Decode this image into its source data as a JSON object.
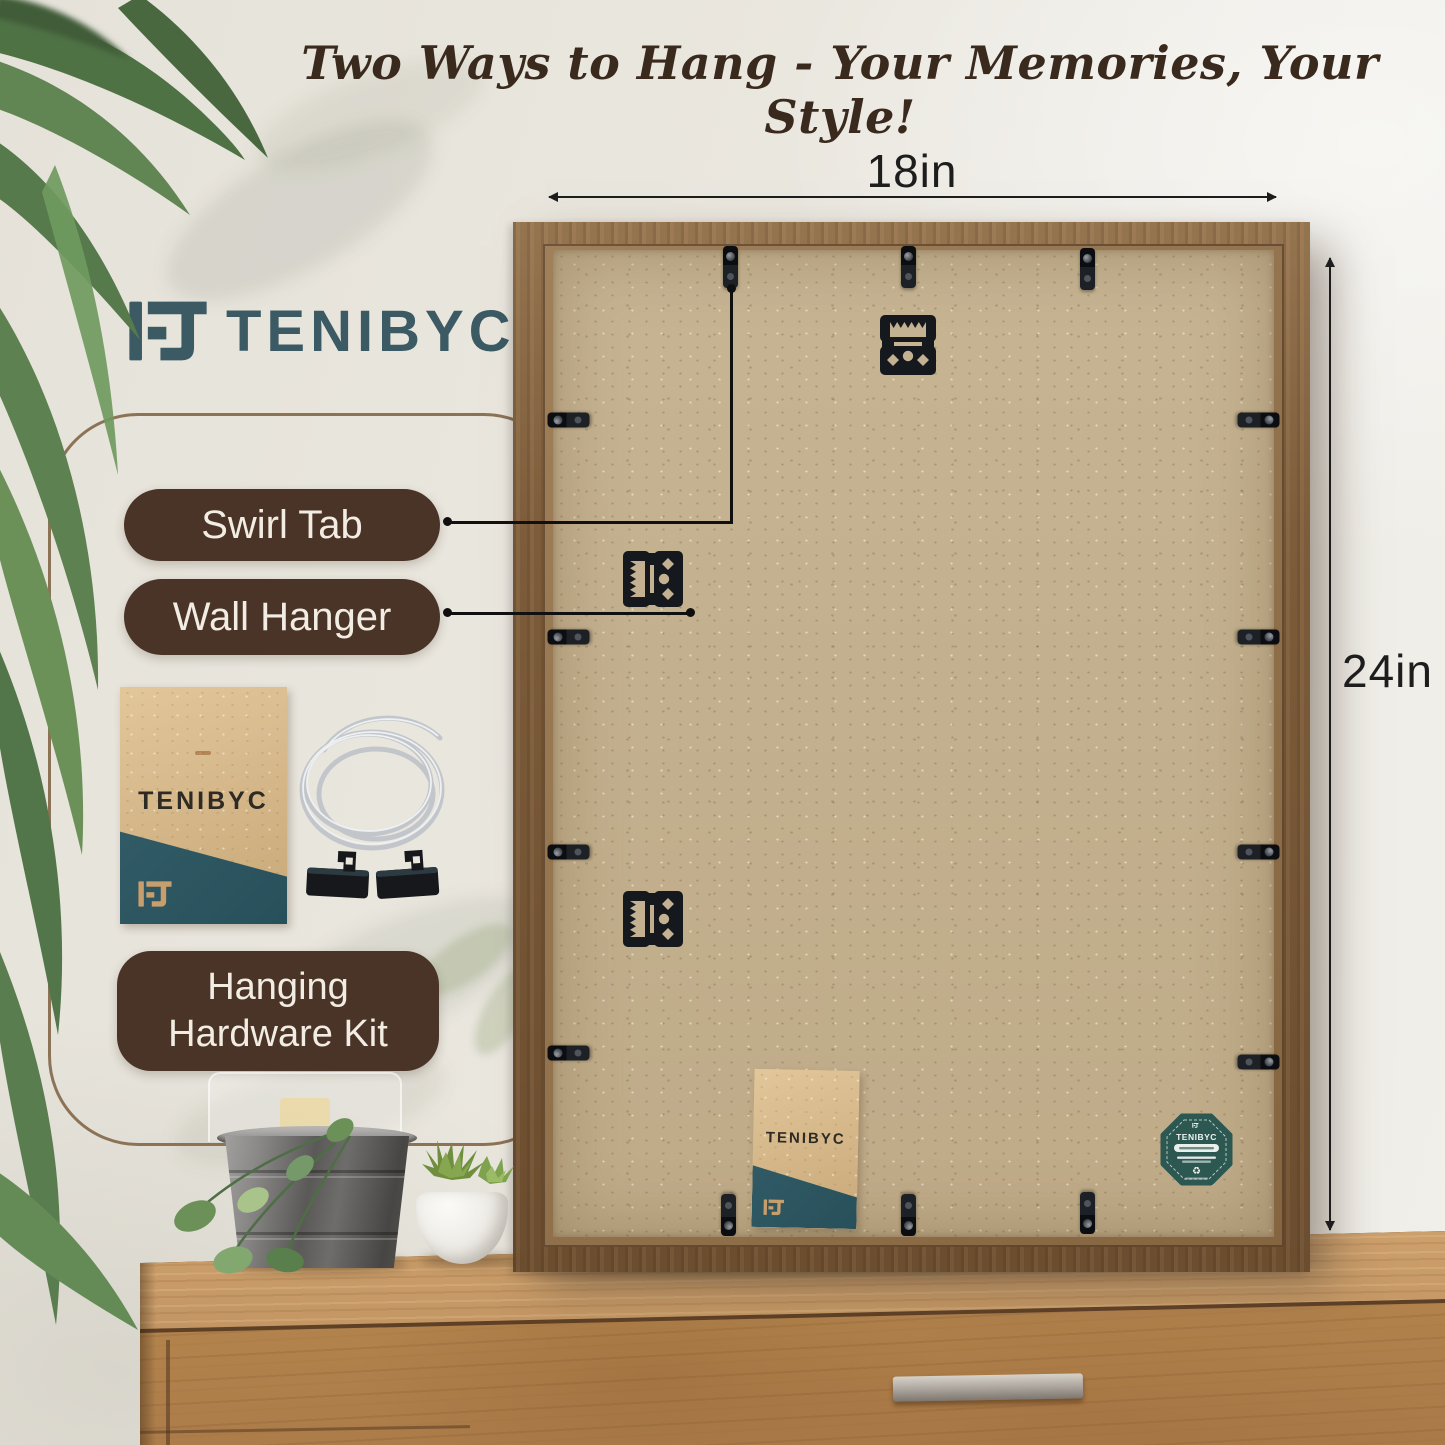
{
  "header": {
    "title": "Two Ways to Hang - Your Memories, Your Style!"
  },
  "brand": {
    "wordmark": "TENIBYC",
    "color": "#3b5a64"
  },
  "dimensions": {
    "width_label": "18in",
    "height_label": "24in"
  },
  "callouts": {
    "swirl_tab": "Swirl Tab",
    "wall_hanger": "Wall Hanger",
    "kit_line1": "Hanging",
    "kit_line2": "Hardware Kit"
  },
  "frame_back": {
    "swirl_tab_count": 14,
    "wall_hanger_count": 3,
    "envelope_brand_ref": "TENIBYC",
    "badge_brand_ref": "TENIBYC"
  },
  "icons": {
    "recycle_glyph": "♻"
  },
  "colors": {
    "label_pill": "#4a3327",
    "brand_teal": "#3b5a64",
    "badge_teal": "#2d5852",
    "frame_wood": "#7c5c3a",
    "kraft_board": "#c3b08f",
    "dresser_wood": "#b68a58",
    "header_text": "#3a2a1e"
  }
}
